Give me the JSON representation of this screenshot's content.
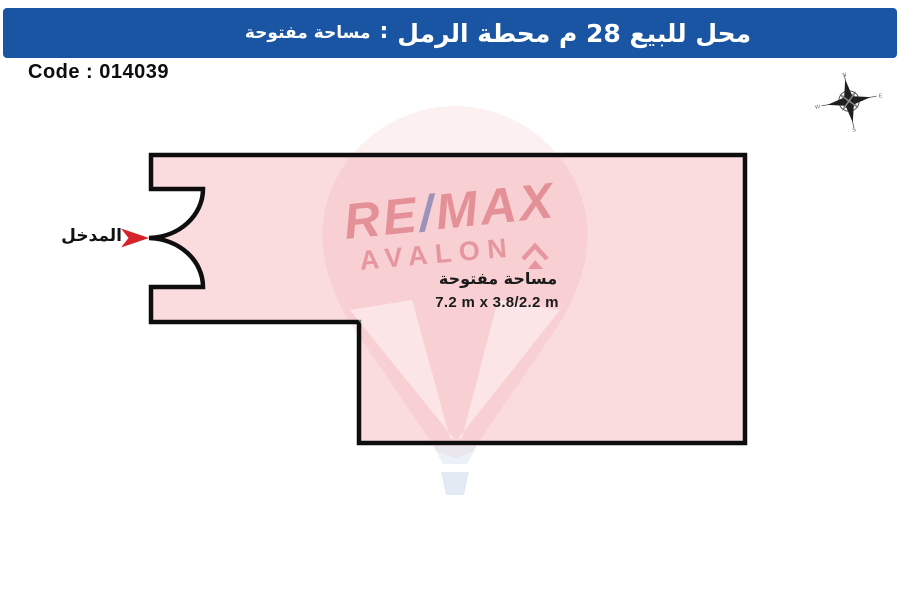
{
  "page": {
    "background": "#FFFFFF"
  },
  "banner": {
    "title_main": "محل للبيع 28 م محطة الرمل",
    "separator": ":",
    "title_sub": "مساحة مفتوحة",
    "bg_color": "#1A55A4",
    "text_color": "#FFFFFF"
  },
  "code": {
    "label": "Code : 014039"
  },
  "plan": {
    "area_label": "مساحة مفتوحة",
    "dimensions_label": "7.2 m x 3.8/2.2 m",
    "entrance_label": "المدخل",
    "fill_color": "#F9DBDE",
    "border_color": "#0E0E0E",
    "arrow_color": "#D6232A"
  },
  "watermark": {
    "brand_re": "RE",
    "brand_slash": "/",
    "brand_max": "MAX",
    "brand_name": "AVALON",
    "red": "#C83C48",
    "blue": "#3E55A0"
  },
  "compass": {
    "north": "N",
    "south": "S",
    "east": "E",
    "west": "W"
  }
}
